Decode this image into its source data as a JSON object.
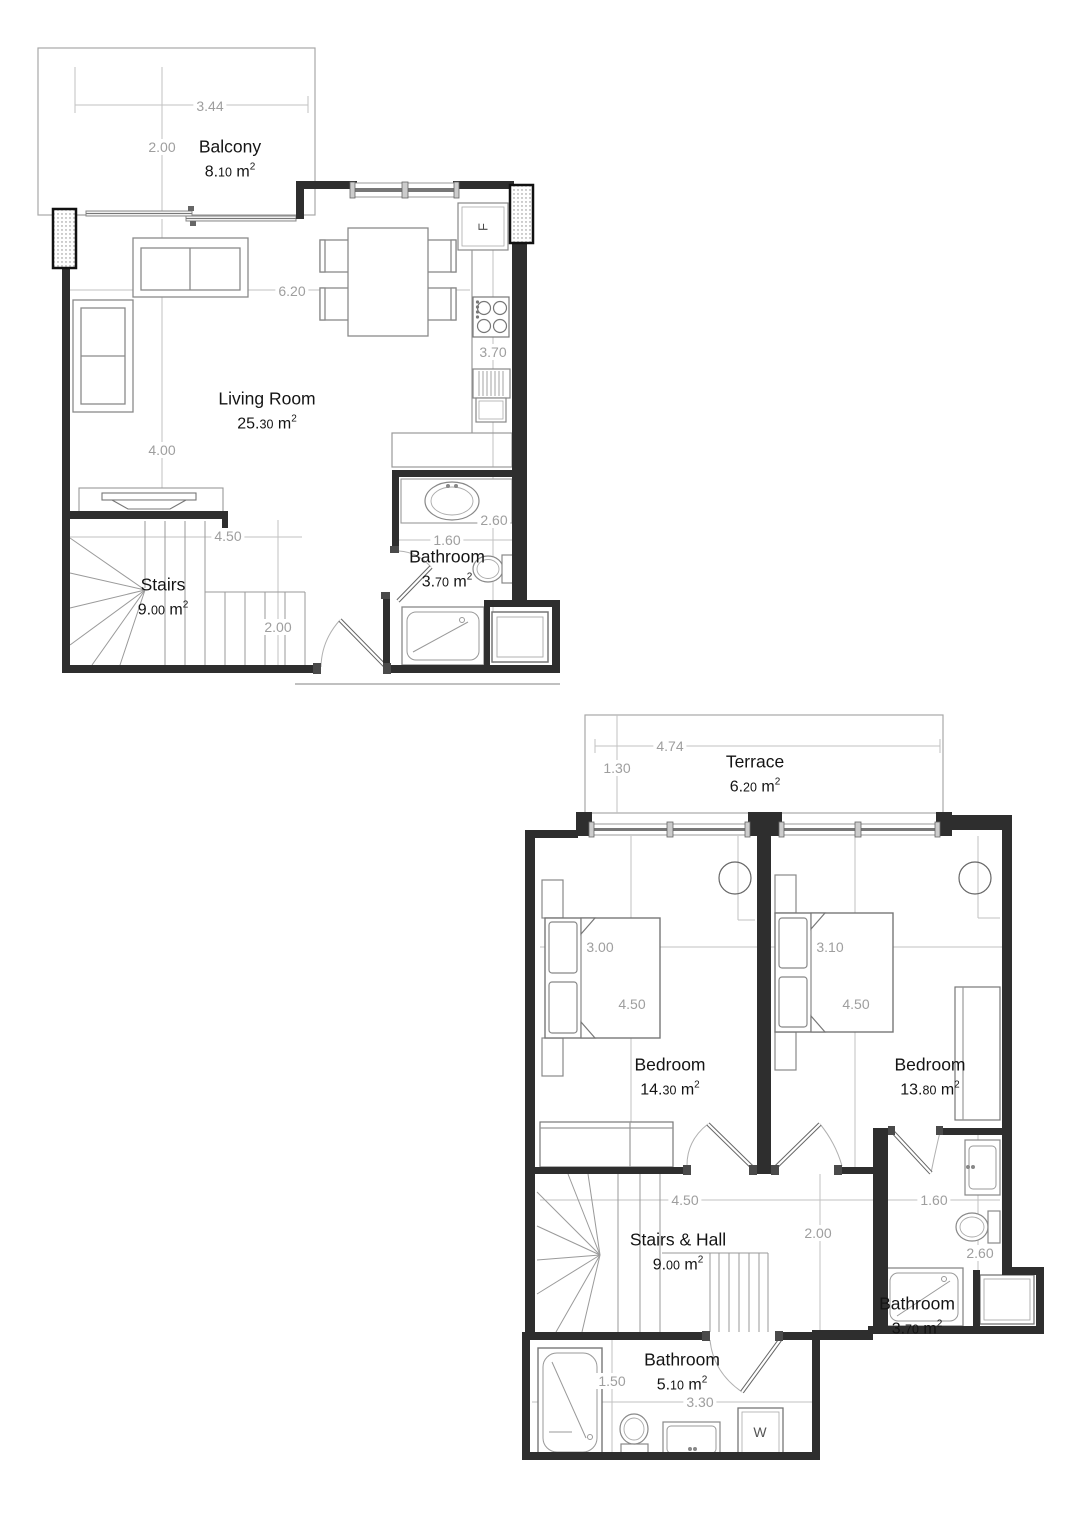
{
  "colors": {
    "background": "#ffffff",
    "wall": "#2e2e2e",
    "furniture_line": "#8a8a8a",
    "dimension_line": "#c2c2c2",
    "dimension_text": "#9e9e9e",
    "label_text": "#141414"
  },
  "floor1": {
    "rooms": [
      {
        "id": "balcony",
        "label": "Balcony",
        "area_int": "8.",
        "area_dec": "10",
        "area_unit": " m",
        "area_exp": "2"
      },
      {
        "id": "living",
        "label": "Living Room",
        "area_int": "25.",
        "area_dec": "30",
        "area_unit": " m",
        "area_exp": "2"
      },
      {
        "id": "stairs",
        "label": "Stairs",
        "area_int": "9.",
        "area_dec": "00",
        "area_unit": " m",
        "area_exp": "2"
      },
      {
        "id": "bathroom",
        "label": "Bathroom",
        "area_int": "3.",
        "area_dec": "70",
        "area_unit": " m",
        "area_exp": "2"
      }
    ],
    "dimensions": [
      "3.44",
      "2.00",
      "6.20",
      "4.00",
      "3.70",
      "2.60",
      "1.60",
      "4.50",
      "2.00"
    ],
    "fridge_label": "F"
  },
  "floor2": {
    "rooms": [
      {
        "id": "terrace",
        "label": "Terrace",
        "area_int": "6.",
        "area_dec": "20",
        "area_unit": " m",
        "area_exp": "2"
      },
      {
        "id": "bedroom1",
        "label": "Bedroom",
        "area_int": "14.",
        "area_dec": "30",
        "area_unit": " m",
        "area_exp": "2"
      },
      {
        "id": "bedroom2",
        "label": "Bedroom",
        "area_int": "13.",
        "area_dec": "80",
        "area_unit": " m",
        "area_exp": "2"
      },
      {
        "id": "stairs_hall",
        "label": "Stairs & Hall",
        "area_int": "9.",
        "area_dec": "00",
        "area_unit": " m",
        "area_exp": "2"
      },
      {
        "id": "bathroom_small",
        "label": "Bathroom",
        "area_int": "3.",
        "area_dec": "70",
        "area_unit": " m",
        "area_exp": "2"
      },
      {
        "id": "bathroom_large",
        "label": "Bathroom",
        "area_int": "5.",
        "area_dec": "10",
        "area_unit": " m",
        "area_exp": "2"
      }
    ],
    "dimensions": [
      "4.74",
      "1.30",
      "3.00",
      "4.50",
      "3.10",
      "4.50",
      "4.50",
      "2.00",
      "1.60",
      "2.60",
      "1.50",
      "3.30"
    ],
    "washer_label": "W"
  }
}
